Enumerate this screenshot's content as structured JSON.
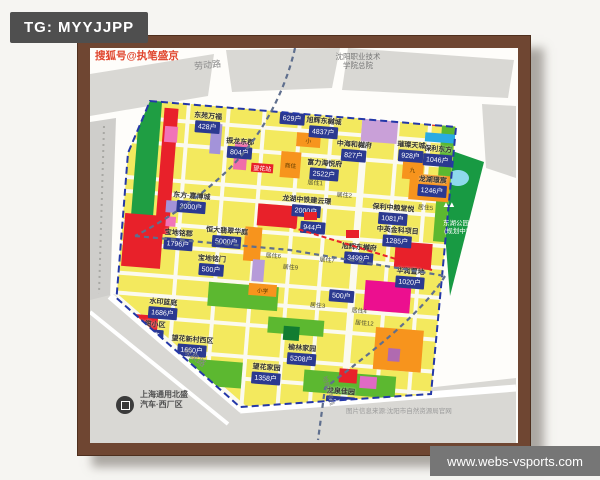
{
  "page": {
    "tg": "TG: MYYJJPP",
    "watermark": "www.webs-vsports.com"
  },
  "map": {
    "credit": "搜狐号@执笔盛京",
    "source_note": "图片信息来源:沈阳市自然资源局官网",
    "roads": {
      "laodong": "劳动路",
      "guanquan": "观泉路",
      "metro4": "地铁四号线"
    },
    "college": {
      "line1": "沈阳职业技术",
      "line2": "学院总院"
    },
    "plant": {
      "line1": "上海通用北盛",
      "line2": "汽车·西厂区"
    },
    "park": {
      "name": "东湖公园",
      "status": "(规划中)"
    },
    "station": {
      "name": "望花站",
      "x": 150,
      "y": 64
    },
    "projects": [
      {
        "n": "东苑万福",
        "u": "428户",
        "cx": 92,
        "y": 16
      },
      {
        "n": "中盛国际花园",
        "u": "629户",
        "cx": 176,
        "y": 1
      },
      {
        "n": "旭辉东樾城",
        "cx": 216,
        "y": 2
      },
      {
        "n": "旭辉东樾城",
        "u": "4837户",
        "cx": 208,
        "y": 12
      },
      {
        "n": "振龙东郡",
        "u": "804户",
        "cx": 126,
        "y": 39
      },
      {
        "n": "富力海悦府",
        "u": "2522户",
        "cx": 212,
        "y": 54
      },
      {
        "n": "中海和樾府",
        "u": "827户",
        "cx": 240,
        "y": 33
      },
      {
        "n": "璀璨天城",
        "u": "928户",
        "cx": 297,
        "y": 29
      },
      {
        "n": "保利东方",
        "u": "1046户",
        "cx": 324,
        "y": 31
      },
      {
        "n": "龙湖璟宸",
        "u": "1246户",
        "cx": 321,
        "y": 62
      },
      {
        "n": "保利中粮堂悦",
        "u": "1081户",
        "cx": 284,
        "y": 93
      },
      {
        "n": "中英金科项目",
        "u": "1285户",
        "cx": 290,
        "y": 115
      },
      {
        "u": "944户",
        "cx": 205,
        "y": 118
      },
      {
        "n": "旭辉东樾府",
        "u": "3499户",
        "cx": 253,
        "y": 135
      },
      {
        "n": "华润置地",
        "u": "1020户",
        "cx": 306,
        "y": 155
      },
      {
        "n": "宝地铭郡",
        "u": "1796户",
        "cx": 72,
        "y": 135
      },
      {
        "n": "恒大翡翠华庭",
        "u": "5000户",
        "cx": 120,
        "y": 129
      },
      {
        "n": "东方·嘉博城",
        "u": "3000户",
        "cx": 82,
        "y": 97
      },
      {
        "n": "龙湖中铁建云璟",
        "u": "2000户",
        "cx": 197,
        "y": 92
      },
      {
        "n": "宝地铭门",
        "u": "500户",
        "cx": 107,
        "y": 158
      },
      {
        "u": "500户",
        "cx": 239,
        "y": 184
      },
      {
        "n": "水印蓝庭",
        "u": "1686户",
        "cx": 62,
        "y": 205
      },
      {
        "n": "电缆小区",
        "u": "865户",
        "cx": 52,
        "y": 228
      },
      {
        "n": "望花新村西区",
        "u": "1660户",
        "cx": 94,
        "y": 240
      },
      {
        "n": "望花家园",
        "u": "1358户",
        "cx": 170,
        "y": 262
      },
      {
        "n": "榆林家园",
        "u": "5208户",
        "cx": 204,
        "y": 240
      },
      {
        "n": "龙泉佳园",
        "u": "2640户",
        "cx": 246,
        "y": 280
      }
    ],
    "area_labels": [
      {
        "t": "居住1",
        "cx": 204,
        "y": 74
      },
      {
        "t": "居住2",
        "cx": 234,
        "y": 84
      },
      {
        "t": "居住3",
        "cx": 216,
        "y": 196
      },
      {
        "t": "居住4",
        "cx": 258,
        "y": 198
      },
      {
        "t": "居住5",
        "cx": 316,
        "y": 90
      },
      {
        "t": "居住6",
        "cx": 168,
        "y": 150
      },
      {
        "t": "居住7",
        "cx": 222,
        "y": 150
      },
      {
        "t": "居住9",
        "cx": 186,
        "y": 160
      },
      {
        "t": "居住12",
        "cx": 264,
        "y": 210
      }
    ],
    "zones": [
      {
        "nm": "green-strip-west",
        "x": 23,
        "y": 8,
        "w": 22,
        "h": 134,
        "c": "#1f9e43"
      },
      {
        "nm": "red-strip-west",
        "x": 48,
        "y": 16,
        "w": 14,
        "h": 126,
        "c": "#e8212a"
      },
      {
        "nm": "pink-block",
        "x": 50,
        "y": 34,
        "w": 13,
        "h": 16,
        "c": "#f173b8"
      },
      {
        "nm": "purple-block",
        "x": 96,
        "y": 28,
        "w": 11,
        "h": 30,
        "c": "#a393d9"
      },
      {
        "nm": "pink-block",
        "x": 121,
        "y": 44,
        "w": 13,
        "h": 28,
        "c": "#f06eaa"
      },
      {
        "nm": "purple-block",
        "x": 57,
        "y": 108,
        "w": 11,
        "h": 12,
        "c": "#a393d9"
      },
      {
        "nm": "pink-block",
        "x": 58,
        "y": 124,
        "w": 10,
        "h": 10,
        "c": "#f173b8"
      },
      {
        "nm": "red-block-sw",
        "x": 17,
        "y": 124,
        "w": 39,
        "h": 53,
        "c": "#e8212a"
      },
      {
        "nm": "green-block",
        "x": 196,
        "y": 2,
        "w": 12,
        "h": 8,
        "c": "#2f9e44"
      },
      {
        "nm": "green-block",
        "x": 210,
        "y": 2,
        "w": 12,
        "h": 8,
        "c": "#2f9e44"
      },
      {
        "nm": "red-block",
        "x": 316,
        "y": 2,
        "w": 12,
        "h": 11,
        "c": "#e8212a"
      },
      {
        "nm": "purple-block-ne",
        "x": 246,
        "y": 2,
        "w": 36,
        "h": 32,
        "c": "#c9a0d8"
      },
      {
        "nm": "green-margin-east",
        "x": 326,
        "y": 6,
        "w": 13,
        "h": 122,
        "c": "#5cb830"
      },
      {
        "nm": "blue-block",
        "x": 310,
        "y": 20,
        "w": 30,
        "h": 9,
        "c": "#29abe2"
      },
      {
        "nm": "orange-block",
        "x": 182,
        "y": 30,
        "w": 24,
        "h": 14,
        "c": "#f7941d",
        "label": "小"
      },
      {
        "nm": "orange-block",
        "x": 168,
        "y": 50,
        "w": 20,
        "h": 26,
        "c": "#f7941d",
        "label": "商住"
      },
      {
        "nm": "orange-block",
        "x": 290,
        "y": 48,
        "w": 21,
        "h": 20,
        "c": "#f7941d",
        "label": "九"
      },
      {
        "nm": "orange-block",
        "x": 298,
        "y": 62,
        "w": 40,
        "h": 26,
        "c": "#f7941d"
      },
      {
        "nm": "red-school-block",
        "x": 149,
        "y": 104,
        "w": 40,
        "h": 22,
        "c": "#e8212a"
      },
      {
        "nm": "orange-strip",
        "x": 138,
        "y": 128,
        "w": 17,
        "h": 34,
        "c": "#f7941d"
      },
      {
        "nm": "red-block-east",
        "x": 289,
        "y": 131,
        "w": 37,
        "h": 26,
        "c": "#e8212a"
      },
      {
        "nm": "magenta-block",
        "x": 262,
        "y": 172,
        "w": 46,
        "h": 30,
        "c": "#ec0f8f"
      },
      {
        "nm": "green-park",
        "x": 106,
        "y": 186,
        "w": 70,
        "h": 24,
        "c": "#5cb830"
      },
      {
        "nm": "green-park",
        "x": 168,
        "y": 216,
        "w": 56,
        "h": 16,
        "c": "#5cb830"
      },
      {
        "nm": "green-park-dark",
        "x": 184,
        "y": 224,
        "w": 16,
        "h": 14,
        "c": "#127c31"
      },
      {
        "nm": "green-park",
        "x": 92,
        "y": 264,
        "w": 54,
        "h": 26,
        "c": "#5cb830"
      },
      {
        "nm": "green-park",
        "x": 208,
        "y": 266,
        "w": 92,
        "h": 22,
        "c": "#5cb830"
      },
      {
        "nm": "red-block",
        "x": 32,
        "y": 224,
        "w": 26,
        "h": 16,
        "c": "#e8212a"
      },
      {
        "nm": "red-block",
        "x": 243,
        "y": 262,
        "w": 18,
        "h": 14,
        "c": "#e8212a"
      },
      {
        "nm": "pink-block",
        "x": 264,
        "y": 268,
        "w": 17,
        "h": 12,
        "c": "#e06ac4"
      },
      {
        "nm": "orange-block-se",
        "x": 276,
        "y": 218,
        "w": 48,
        "h": 42,
        "c": "#f7941d"
      },
      {
        "nm": "purple-block",
        "x": 290,
        "y": 238,
        "w": 12,
        "h": 13,
        "c": "#b06ab0"
      },
      {
        "nm": "purple-block",
        "x": 148,
        "y": 160,
        "w": 12,
        "h": 22,
        "c": "#b69bd9"
      },
      {
        "nm": "orange-block",
        "x": 146,
        "y": 184,
        "w": 28,
        "h": 12,
        "c": "#f7941d",
        "label": "小学"
      }
    ]
  }
}
